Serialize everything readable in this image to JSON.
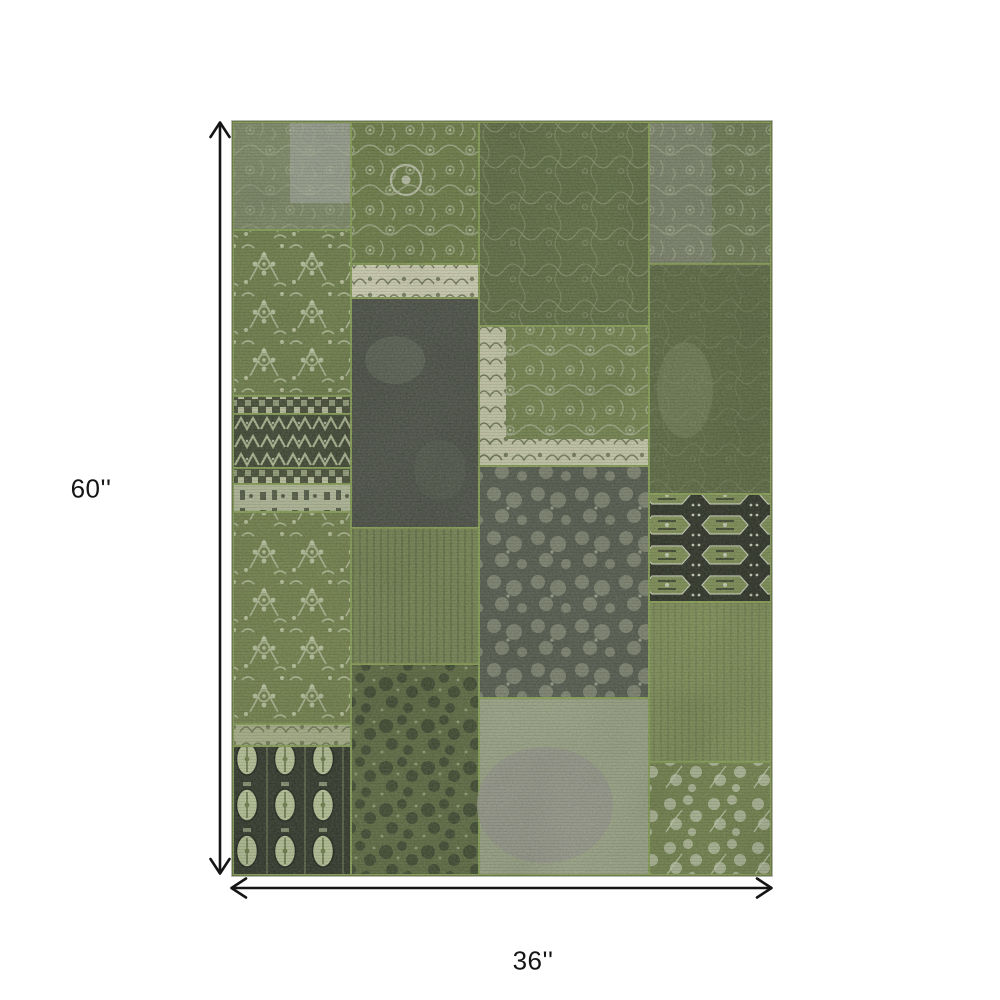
{
  "figure": {
    "type": "product dimension diagram",
    "product": "green patchwork area rug",
    "height_label": "60''",
    "width_label": "36''",
    "background": "#ffffff",
    "line_color": "#151515"
  },
  "rug": {
    "palette": {
      "seam_green": "#87a055",
      "ivory": "#cfd0b2",
      "charcoal": "#4b5045",
      "black_patch": "#2e3326",
      "motif_light": "#b9bfa6",
      "gray_fade": "#9aa385"
    },
    "patches": {
      "seam": {
        "fill": "#87a055"
      },
      "a1": {
        "fill": "#7e8a66"
      },
      "a1_gray_block": {
        "fill": "#979e8c"
      },
      "a2": {
        "fill": "#6f7f4a"
      },
      "a3": {
        "fill": "#474f36"
      },
      "a4": {
        "fill": "#3f4732"
      },
      "a5": {
        "fill": "#474f36"
      },
      "a6": {
        "fill": "#b2ba98"
      },
      "a7": {
        "fill": "#74834c"
      },
      "a8": {
        "fill": "#a9b188"
      },
      "a9": {
        "fill": "#31382a"
      },
      "b1": {
        "fill": "#6d7d46"
      },
      "b2": {
        "fill": "#cfd0b2"
      },
      "b3": {
        "fill": "#4b5045"
      },
      "b4": {
        "fill": "#758552"
      },
      "b5": {
        "fill": "#5d6b41"
      },
      "c1": {
        "fill": "#5f6f44"
      },
      "c2_field": {
        "fill": "#75854e"
      },
      "c2_border": {
        "fill": "#c6c9a8"
      },
      "c3": {
        "fill": "#565c4e"
      },
      "c4": {
        "fill": "#9aa385"
      },
      "c4_blob": {
        "fill": "#95958b"
      },
      "d1": {
        "fill": "#6d7a52"
      },
      "d1_gray": {
        "fill": "#7e8570"
      },
      "d2": {
        "fill": "#5c6a42"
      },
      "d3": {
        "fill": "#2e3326"
      },
      "d4": {
        "fill": "#7f8f57"
      },
      "d5": {
        "fill": "#72824c"
      }
    }
  }
}
